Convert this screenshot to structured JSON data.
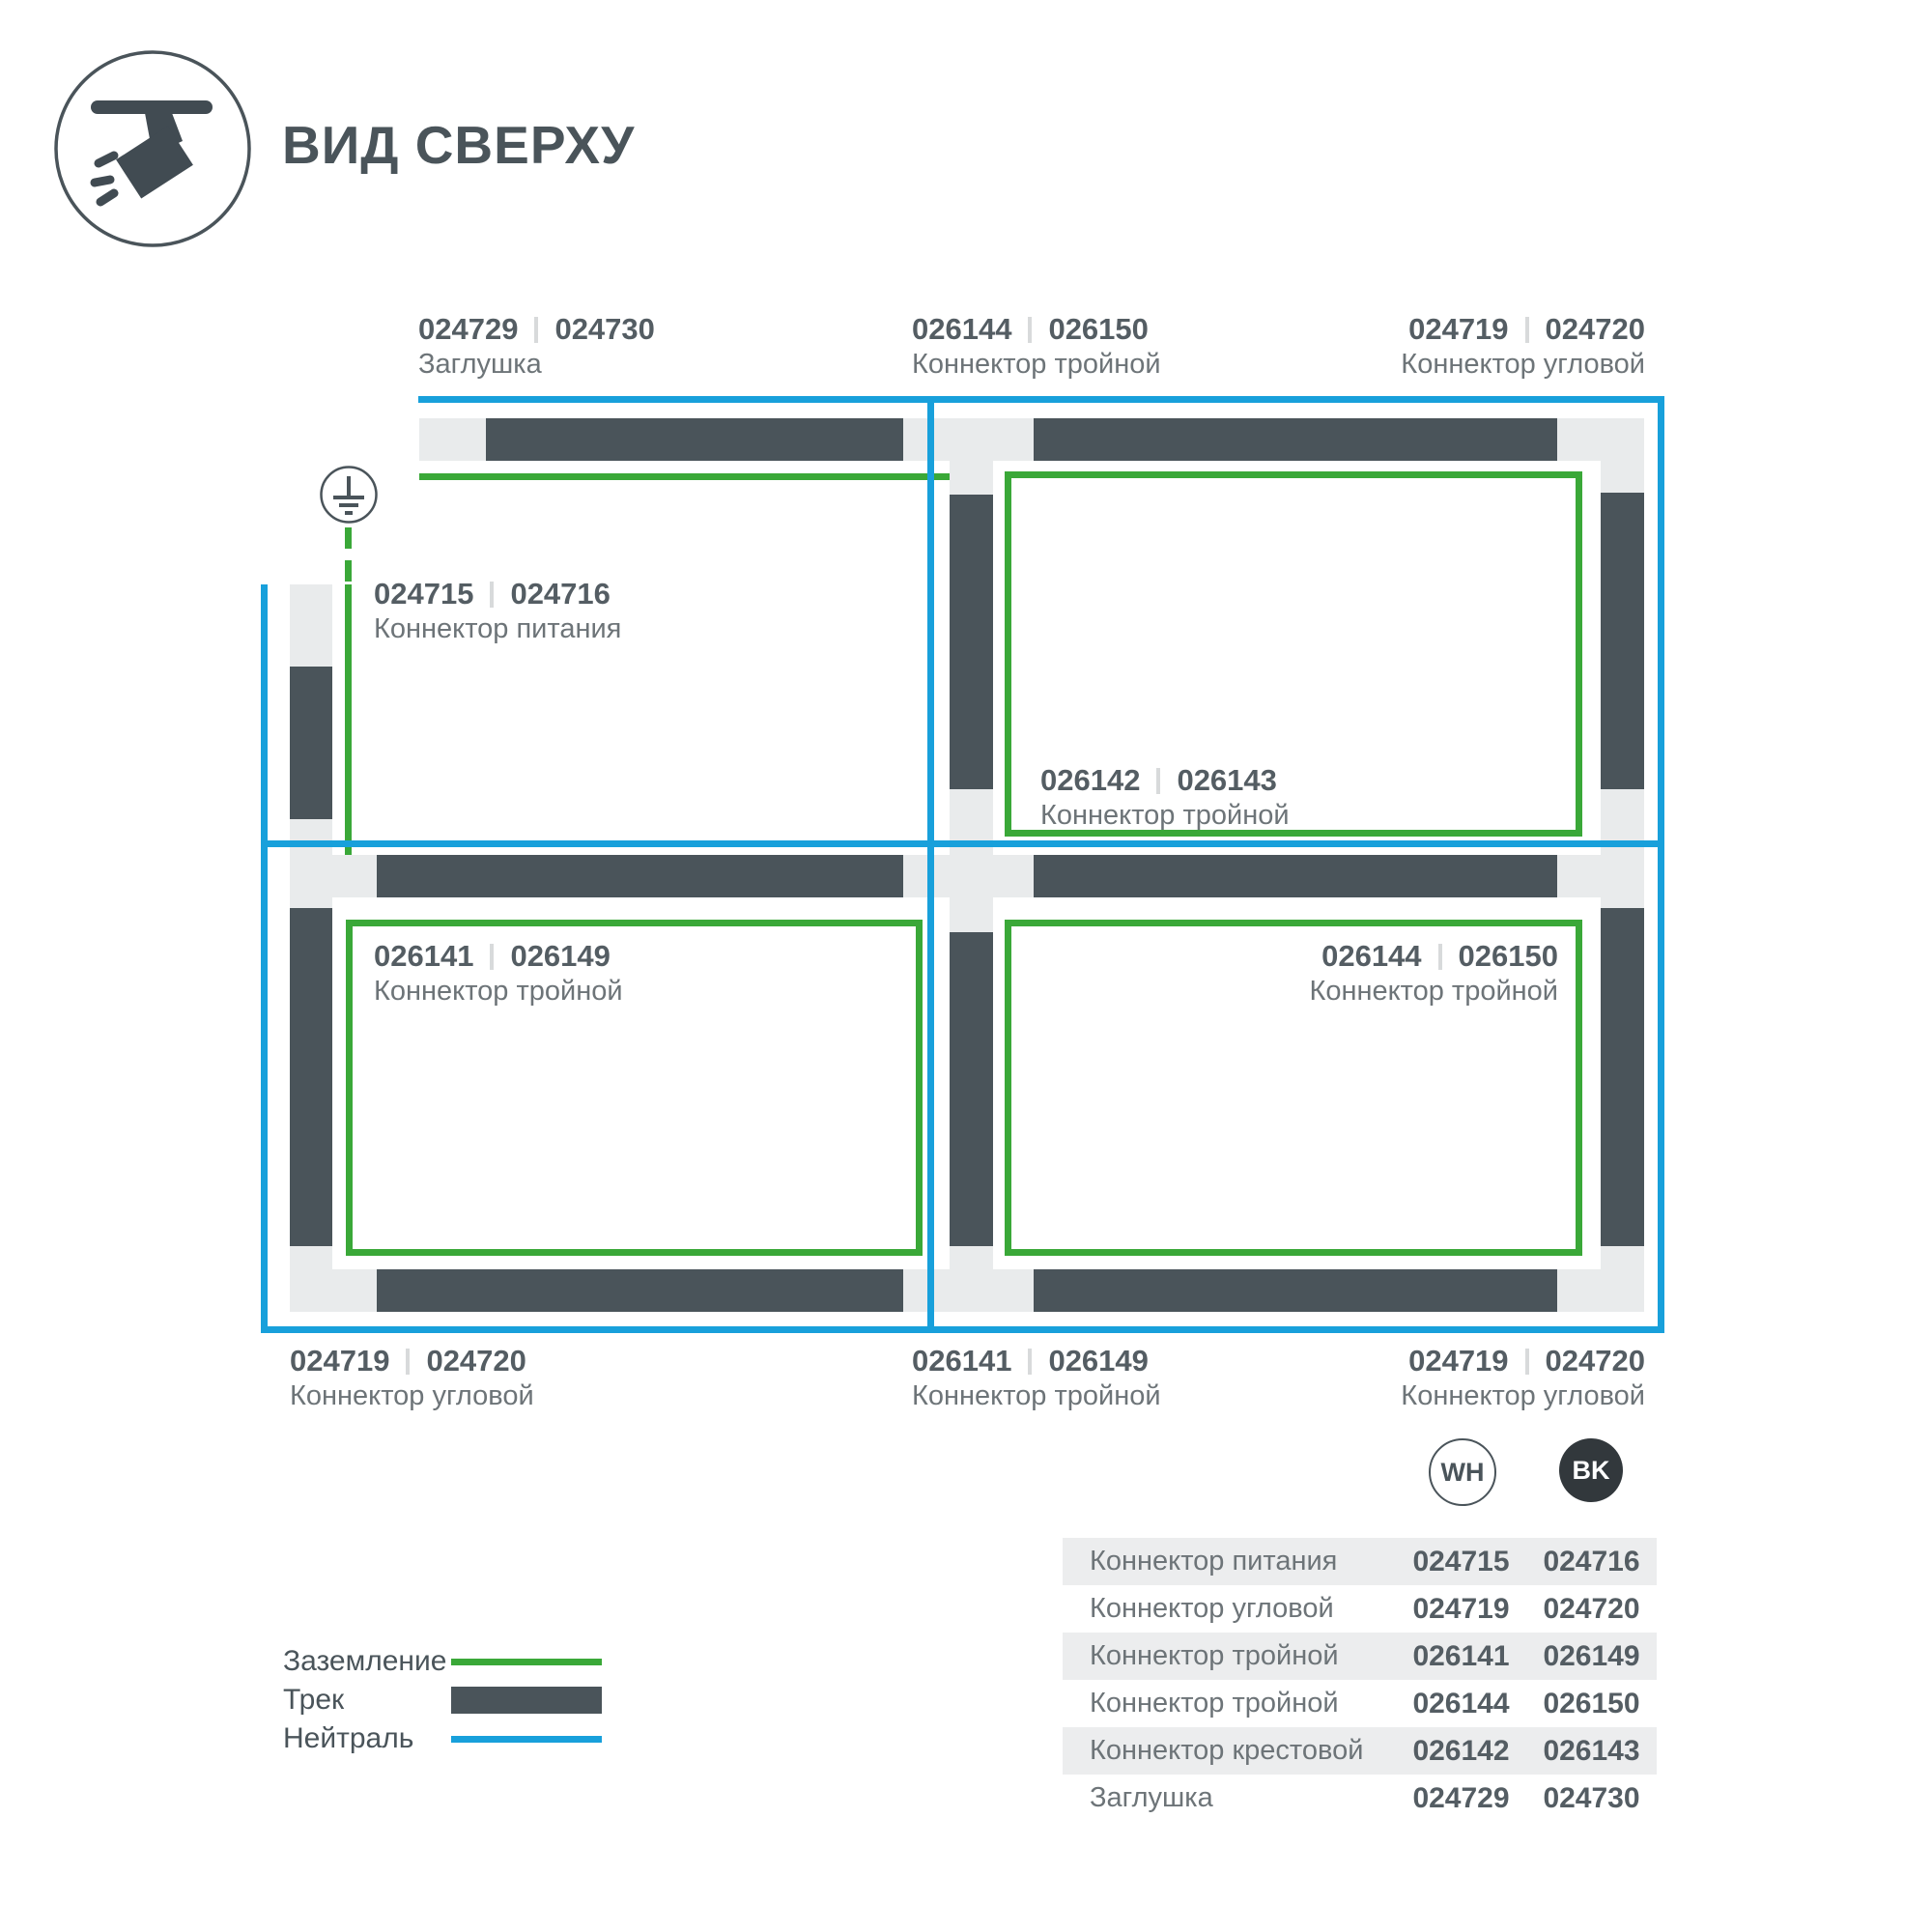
{
  "colors": {
    "track": "#4a545a",
    "connector": "#e9ebec",
    "ground": "#3aa838",
    "neutral": "#18a0db",
    "text_dark": "#545d63",
    "text_mid": "#6d7478",
    "row_gray": "#ecedee",
    "badge_dark": "#32383c"
  },
  "header": {
    "title": "ВИД СВЕРХУ",
    "icon": "track-spotlight-icon"
  },
  "diagram": {
    "ground_icon": "earth-ground-icon",
    "labels": [
      {
        "code_wh": "024729",
        "code_bk": "024730",
        "name": "Заглушка"
      },
      {
        "code_wh": "026144",
        "code_bk": "026150",
        "name": "Коннектор тройной"
      },
      {
        "code_wh": "024719",
        "code_bk": "024720",
        "name": "Коннектор угловой"
      },
      {
        "code_wh": "024715",
        "code_bk": "024716",
        "name": "Коннектор питания"
      },
      {
        "code_wh": "026142",
        "code_bk": "026143",
        "name": "Коннектор тройной"
      },
      {
        "code_wh": "026141",
        "code_bk": "026149",
        "name": "Коннектор тройной"
      },
      {
        "code_wh": "026144",
        "code_bk": "026150",
        "name": "Коннектор тройной"
      },
      {
        "code_wh": "024719",
        "code_bk": "024720",
        "name": "Коннектор угловой"
      },
      {
        "code_wh": "026141",
        "code_bk": "026149",
        "name": "Коннектор тройной"
      },
      {
        "code_wh": "024719",
        "code_bk": "024720",
        "name": "Коннектор угловой"
      }
    ]
  },
  "legend": {
    "items": [
      {
        "label": "Заземление",
        "swatch": "ground-line"
      },
      {
        "label": "Трек",
        "swatch": "track-bar"
      },
      {
        "label": "Нейтраль",
        "swatch": "neutral-line"
      }
    ]
  },
  "table": {
    "columns": [
      {
        "badge": "WH"
      },
      {
        "badge": "BK"
      }
    ],
    "rows": [
      {
        "name": "Коннектор питания",
        "wh": "024715",
        "bk": "024716"
      },
      {
        "name": "Коннектор угловой",
        "wh": "024719",
        "bk": "024720"
      },
      {
        "name": "Коннектор тройной",
        "wh": "026141",
        "bk": "026149"
      },
      {
        "name": "Коннектор тройной",
        "wh": "026144",
        "bk": "026150"
      },
      {
        "name": "Коннектор крестовой",
        "wh": "026142",
        "bk": "026143"
      },
      {
        "name": "Заглушка",
        "wh": "024729",
        "bk": "024730"
      }
    ]
  }
}
